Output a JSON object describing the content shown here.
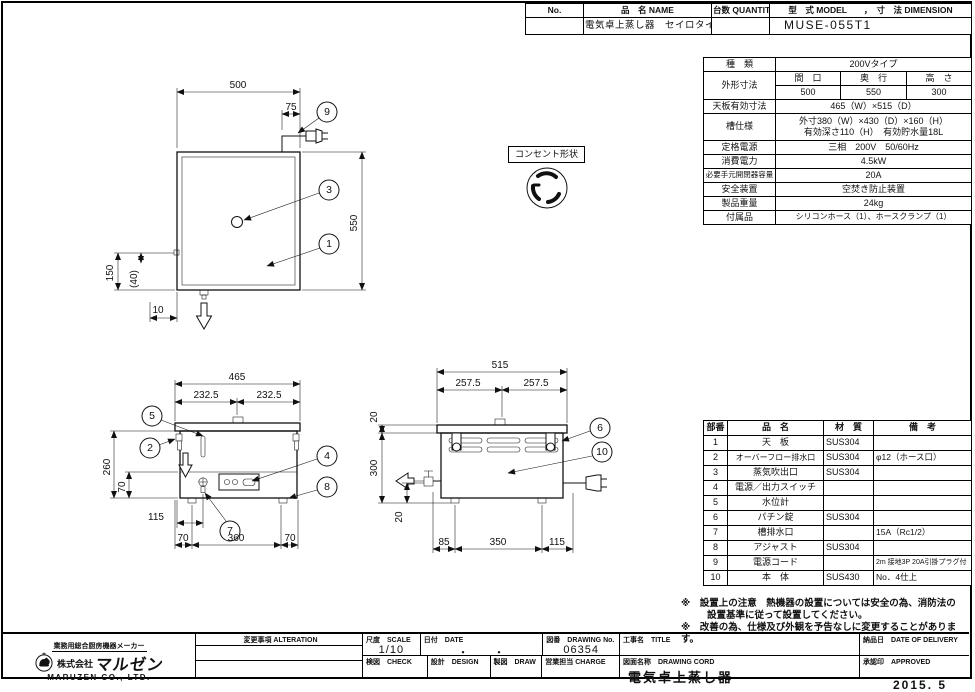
{
  "header_table": {
    "no_label": "No.",
    "name_label": "品　名 NAME",
    "qty_label": "台数 QUANTITY",
    "model_label": "型　式 MODEL　　，　寸　法 DIMENSION",
    "name_value": "電気卓上蒸し器　セイロタイプ",
    "model_value": "MUSE-055T1"
  },
  "spec_table": {
    "type_label": "種　類",
    "type_value": "200Vタイプ",
    "outer_label": "外形寸法",
    "w_label": "間　口",
    "d_label": "奥　行",
    "h_label": "高　さ",
    "w_value": "500",
    "d_value": "550",
    "h_value": "300",
    "top_label": "天板有効寸法",
    "top_value": "465（W）×515（D）",
    "tank_label": "槽仕様",
    "tank_value1": "外寸380（W）×430（D）×160（H）",
    "tank_value2": "有効深さ110（H）　有効貯水量18L",
    "power_label": "定格電源",
    "power_value": "三相　200V　50/60Hz",
    "consumption_label": "消費電力",
    "consumption_value": "4.5kW",
    "breaker_label": "必要手元開閉器容量",
    "breaker_value": "20A",
    "safety_label": "安全装置",
    "safety_value": "空焚き防止装置",
    "weight_label": "製品重量",
    "weight_value": "24kg",
    "accessory_label": "付属品",
    "accessory_value": "シリコンホース（1）、ホースクランプ（1）"
  },
  "outlet": {
    "label": "コンセント形状"
  },
  "parts_table": {
    "headers": {
      "no": "部番",
      "name": "品　名",
      "material": "材　質",
      "note": "備　考"
    },
    "rows": [
      {
        "no": "1",
        "name": "天　板",
        "material": "SUS304",
        "note": ""
      },
      {
        "no": "2",
        "name": "オーバーフロー排水口",
        "material": "SUS304",
        "note": "φ12（ホース口）"
      },
      {
        "no": "3",
        "name": "蒸気吹出口",
        "material": "SUS304",
        "note": ""
      },
      {
        "no": "4",
        "name": "電源／出力スイッチ",
        "material": "",
        "note": ""
      },
      {
        "no": "5",
        "name": "水位計",
        "material": "",
        "note": ""
      },
      {
        "no": "6",
        "name": "パチン錠",
        "material": "SUS304",
        "note": ""
      },
      {
        "no": "7",
        "name": "槽排水口",
        "material": "",
        "note": "15A（Rc1/2）"
      },
      {
        "no": "8",
        "name": "アジャスト",
        "material": "SUS304",
        "note": ""
      },
      {
        "no": "9",
        "name": "電源コード",
        "material": "",
        "note": "2m 接地3P 20A引掛プラグ付"
      },
      {
        "no": "10",
        "name": "本　体",
        "material": "SUS430",
        "note": "No．4仕上"
      }
    ]
  },
  "notes": {
    "line1": "※　設置上の注意　熱機器の設置については安全の為、消防法の",
    "line2": "設置基準に従って設置してください。",
    "line3": "※　改善の為、仕様及び外観を予告なしに変更することがあります。"
  },
  "title_block": {
    "alteration_label": "変更事項 ALTERATION",
    "scale_label": "尺度　SCALE",
    "scale_value": "1/10",
    "date_label": "日付　DATE",
    "date_value": "・　　・",
    "drawing_no_label": "図番　DRAWING No.",
    "drawing_no_value": "06354",
    "check_label": "検図　CHECK",
    "design_label": "設計　DESIGN",
    "draw_label": "製図　DRAW",
    "charge_label": "営業担当 CHARGE",
    "title_label": "工事名　TITLE",
    "drawing_name_label": "図面名称　DRAWING CORD",
    "drawing_name_value": "電気卓上蒸し器",
    "delivery_label": "納品日　DATE OF DELIVERY",
    "approved_label": "承認印　APPROVED",
    "stamp_date": "2015. 5"
  },
  "maker": {
    "tagline": "業務用総合厨房機器メーカー",
    "company_prefix": "株式会社",
    "company_name": "マルゼン",
    "company_en": "MARUZEN  CO., LTD."
  },
  "drawing": {
    "plan": {
      "w": "500",
      "cord": "75",
      "d": "550",
      "left": "150",
      "left2": "(40)",
      "bottom": "10",
      "b9": "9",
      "b3": "3",
      "b1": "1"
    },
    "front": {
      "w": "465",
      "hl": "232.5",
      "hr": "232.5",
      "h": "260",
      "h2": "70",
      "drain": "115",
      "b_l": "70",
      "b_m": "360",
      "b_r": "70",
      "n5": "5",
      "n2": "2",
      "n4": "4",
      "n8": "8",
      "n7": "7"
    },
    "side": {
      "w": "515",
      "hl": "257.5",
      "hr": "257.5",
      "t": "20",
      "h": "300",
      "leg": "20",
      "b_l": "85",
      "b_m": "350",
      "b_r": "115",
      "n6": "6",
      "n10": "10"
    }
  }
}
